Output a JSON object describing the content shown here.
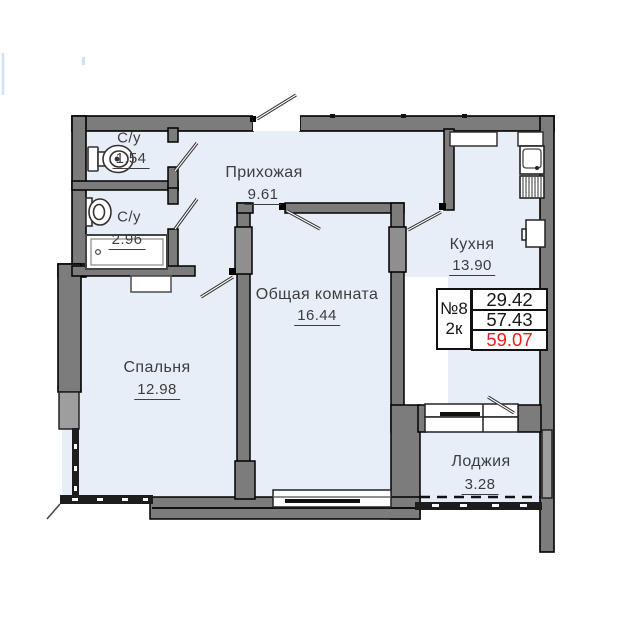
{
  "plan": {
    "rooms": [
      {
        "name": "С/у",
        "area": "1.54"
      },
      {
        "name": "С/у",
        "area": "2.96"
      },
      {
        "name": "Прихожая",
        "area": "9.61"
      },
      {
        "name": "Кухня",
        "area": "13.90"
      },
      {
        "name": "Общая комната",
        "area": "16.44"
      },
      {
        "name": "Спальня",
        "area": "12.98"
      },
      {
        "name": "Лоджия",
        "area": "3.28"
      }
    ],
    "info_box": {
      "unit_number": "№8",
      "unit_type": "2к",
      "values": [
        "29.42",
        "57.43",
        "59.07"
      ]
    },
    "colors": {
      "floor_fill": "#e7eef8",
      "wall_fill": "#7c7c7c",
      "window_fill": "#9e9e9e",
      "outline": "#000000",
      "text": "#3d3d3d",
      "total_area_red": "#ee1d1d",
      "glazing_dark": "#1d1d1d"
    }
  }
}
